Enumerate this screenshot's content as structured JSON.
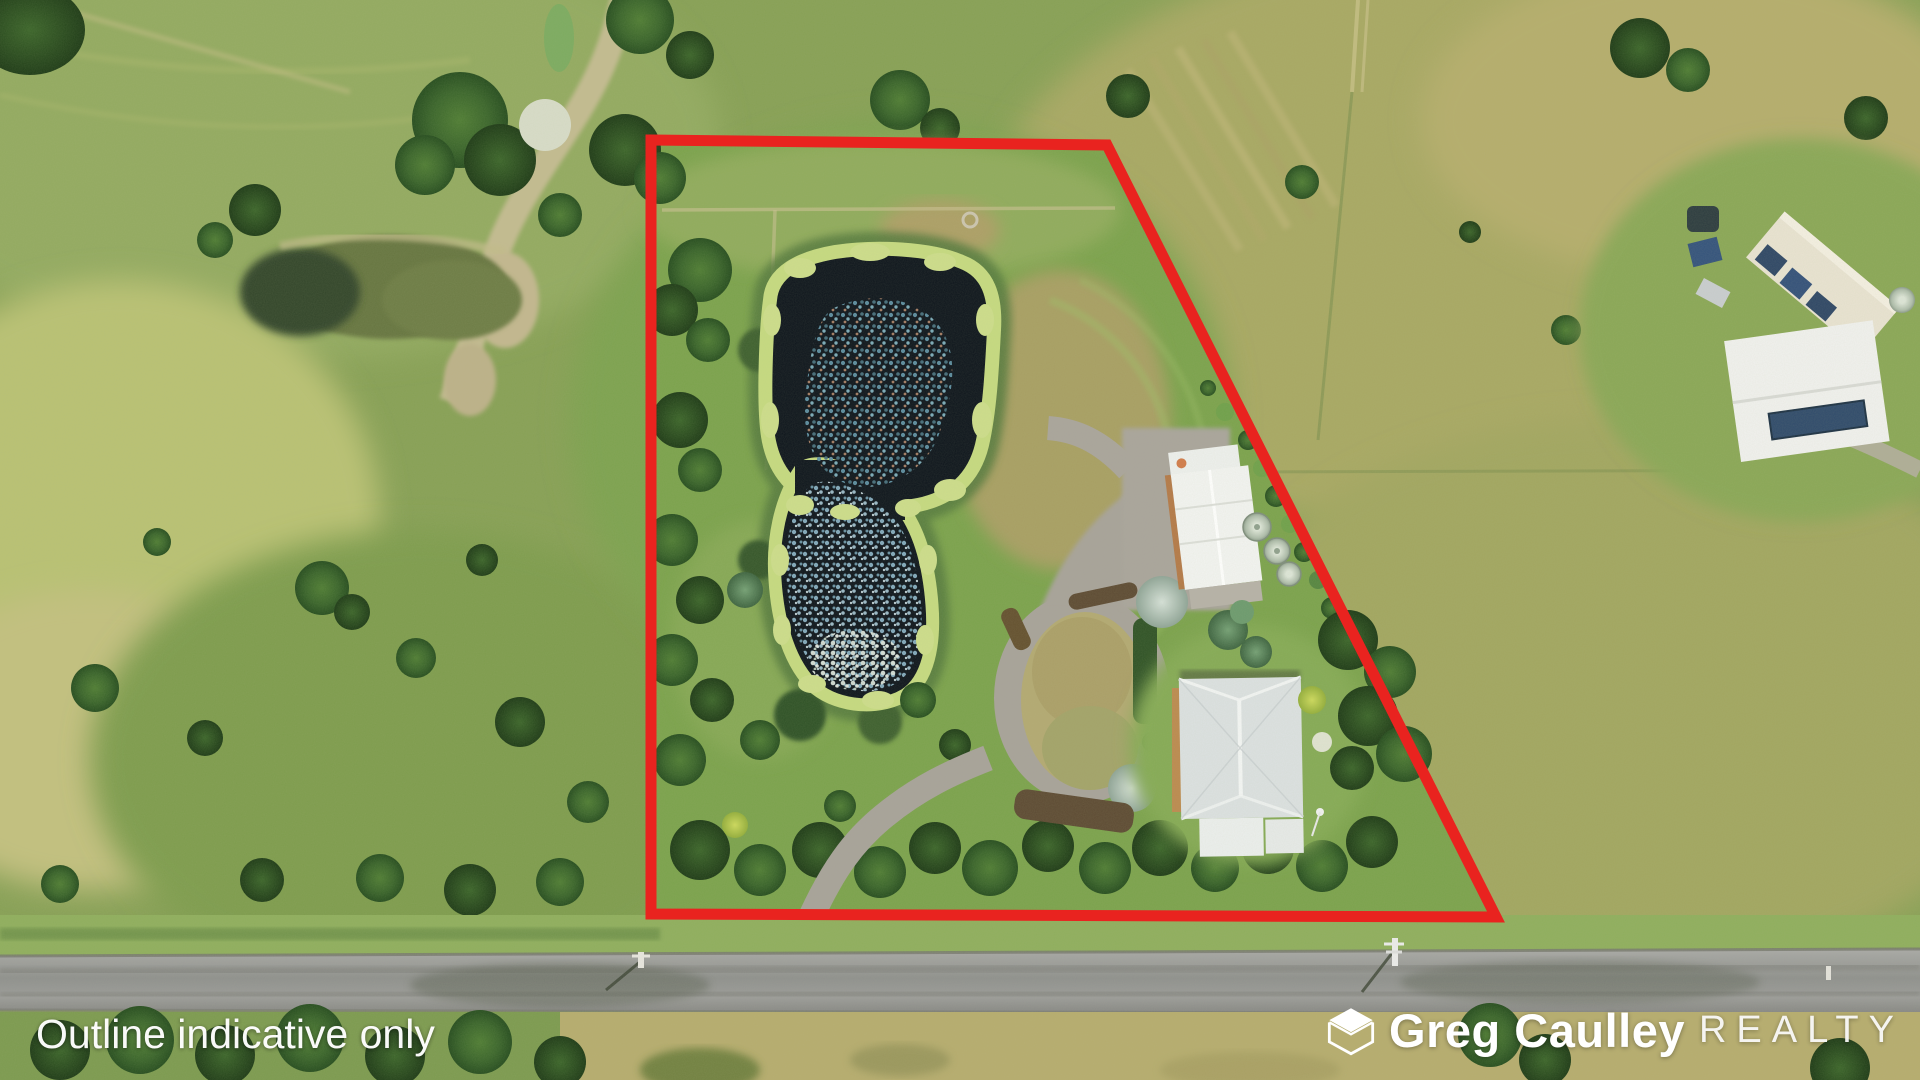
{
  "photo": {
    "kind": "aerial-drone-photo",
    "width_px": 1920,
    "height_px": 1080,
    "subject": "rural acreage property with lily pond, house, shed and circular driveway"
  },
  "overlay": {
    "disclaimer": "Outline indicative only",
    "brand": {
      "name": "Greg Caulley",
      "suffix": "REALTY"
    }
  },
  "colors": {
    "outline_red": "#e9231f",
    "text_white": "#ffffff"
  },
  "boundary": {
    "shape": "quadrilateral",
    "vertices": [
      [
        651,
        140
      ],
      [
        1107,
        145
      ],
      [
        1496,
        917
      ],
      [
        651,
        914
      ]
    ],
    "stroke_width": 11
  }
}
